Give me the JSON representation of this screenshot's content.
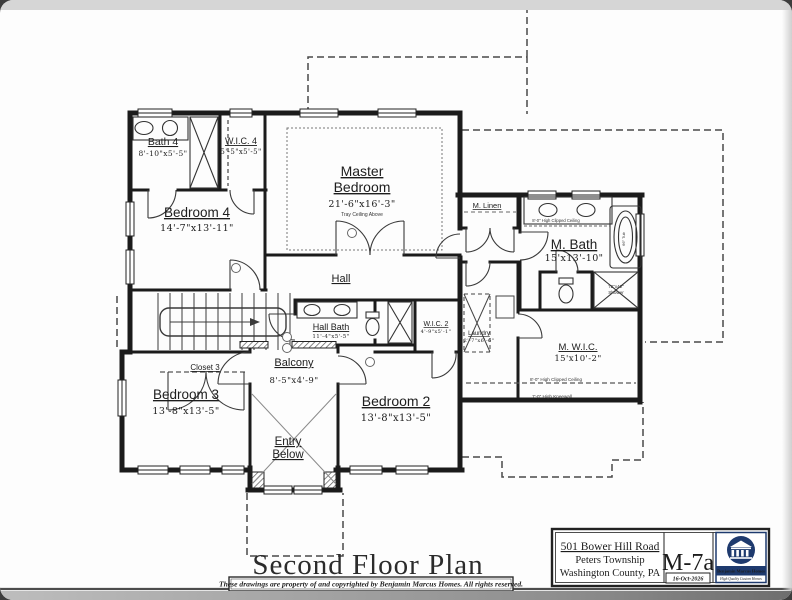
{
  "sheet": {
    "plan_title": "Second Floor Plan",
    "copyright_notice": "These drawings are property of and copyrighted by Benjamin Marcus Homes. All rights reserved."
  },
  "title_block": {
    "address_line1": "501 Bower Hill Road",
    "address_line2": "Peters Township",
    "address_line3": "Washington County, PA",
    "sheet_number": "M-7a",
    "date": "16-Oct-2026",
    "logo_company": "Benjamin Marcus Homes",
    "logo_tagline": "High Quality Custom Homes",
    "logo_color": "#1e3a6e"
  },
  "rooms": {
    "bath4": {
      "name": "Bath 4",
      "dims": "8'-10\"x5'-5\""
    },
    "wic4": {
      "name": "W.I.C. 4",
      "dims": "5'-5\"x5'-5\""
    },
    "master": {
      "name_line1": "Master",
      "name_line2": "Bedroom",
      "dims": "21'-6\"x16'-3\"",
      "note": "Tray Ceiling Above"
    },
    "bedroom4": {
      "name": "Bedroom 4",
      "dims": "14'-7\"x13'-11\""
    },
    "hall": {
      "name": "Hall"
    },
    "m_linen": {
      "name": "M. Linen"
    },
    "m_bath": {
      "name": "M. Bath",
      "dims": "15'x13'-10\""
    },
    "hall_bath": {
      "name": "Hall Bath",
      "dims": "11'-4\"x5'-5\""
    },
    "wic2": {
      "name": "W.I.C. 2",
      "dims": "4'-9\"x5'-1\""
    },
    "laundry": {
      "name": "Laundry",
      "dims": "2'-7\"x6'-6\""
    },
    "m_wic": {
      "name": "M. W.I.C.",
      "dims": "15'x10'-2\""
    },
    "balcony": {
      "name": "Balcony",
      "dims": "8'-5\"x4'-9\""
    },
    "bedroom3": {
      "name": "Bedroom 3",
      "dims": "13'-8\"x13'-5\""
    },
    "bedroom2": {
      "name": "Bedroom 2",
      "dims": "13'-8\"x13'-5\""
    },
    "closet3": {
      "name": "Closet 3"
    },
    "entry_below": {
      "name_line1": "Entry",
      "name_line2": "Below"
    }
  },
  "annotations": {
    "clipped_ceiling": "8'-0\" High Clipped Ceiling",
    "kneewall": "7'-0\" High Kneewall",
    "shower_size_line1": "72\"x42\"",
    "shower_size_line2": "Shower",
    "tub": "66\" Tub"
  }
}
